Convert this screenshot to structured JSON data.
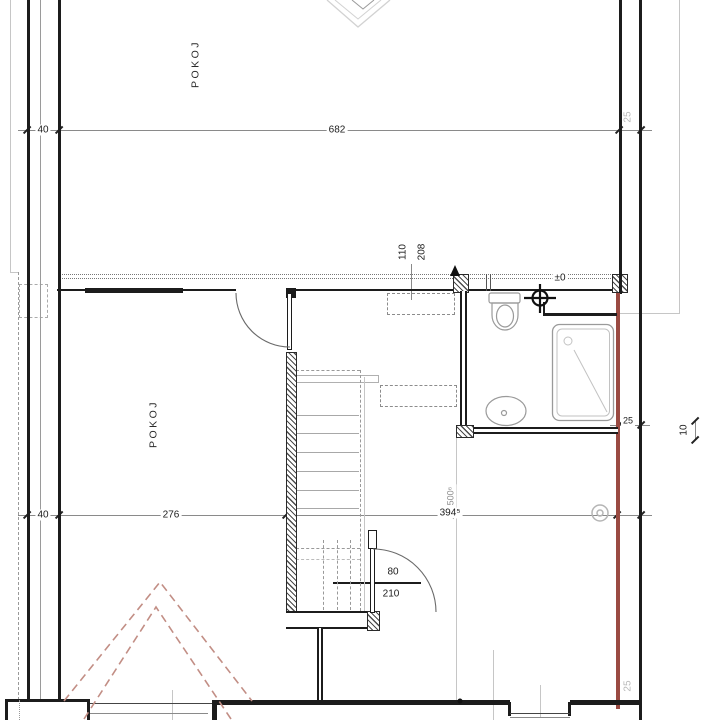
{
  "drawing_title": "floor-plan",
  "rooms": {
    "upper": "POKOJ",
    "lower": "POKOJ"
  },
  "levels": {
    "floor": "±0"
  },
  "dims": {
    "wall_left_top": "40",
    "span_top": "682",
    "wall_right_top": "25",
    "wall_left_mid": "40",
    "room_width": "276",
    "hall_width": "394⁵",
    "hall_width_vert": "500⁶",
    "window_width": "110",
    "window_height": "208",
    "door_width": "80",
    "door_height": "210",
    "bath_wall": "25",
    "step_right": "10",
    "wall_right_bottom": "25"
  },
  "colors": {
    "wall_accent_red": "#9a4a42",
    "roof_dashed_red": "#c28e85",
    "drawing_line": "#1c1c1c",
    "light_line": "#b5b5b5"
  }
}
